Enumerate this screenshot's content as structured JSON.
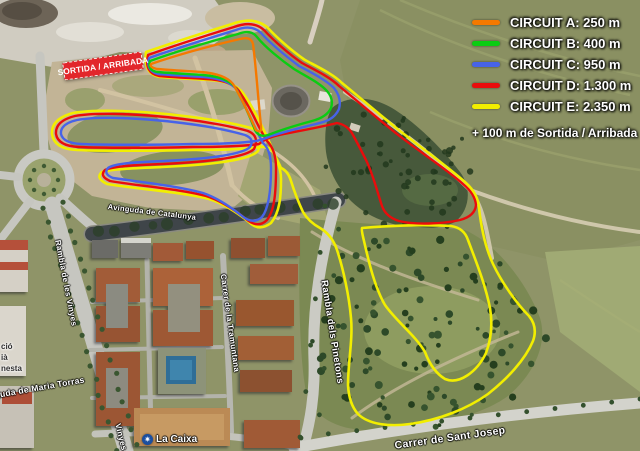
{
  "legend": {
    "items": [
      {
        "id": "A",
        "label": "CIRCUIT A: 250 m",
        "color": "#F57900"
      },
      {
        "id": "B",
        "label": "CIRCUIT B: 400 m",
        "color": "#0ACC12"
      },
      {
        "id": "C",
        "label": "CIRCUIT C: 950 m",
        "color": "#4763E8"
      },
      {
        "id": "D",
        "label": "CIRCUIT D: 1.300 m",
        "color": "#EA0C0C"
      },
      {
        "id": "E",
        "label": "CIRCUIT E: 2.350 m",
        "color": "#F2EE00"
      }
    ],
    "note": "+ 100 m de Sortida / Arribada"
  },
  "banner": {
    "text": "SORTIDA / ARRIBADA"
  },
  "streets": [
    {
      "text": "Rambla de les Vinyes",
      "x": 66,
      "y": 283,
      "rot": 79,
      "size": 8
    },
    {
      "text": "Vinyes",
      "x": 121,
      "y": 437,
      "rot": 76,
      "size": 8
    },
    {
      "text": "Avinguda de Catalunya",
      "x": 152,
      "y": 212,
      "rot": 7,
      "size": 7.5
    },
    {
      "text": "Carrer de la Tramuntana",
      "x": 230,
      "y": 323,
      "rot": 82,
      "size": 8
    },
    {
      "text": "Rambla dels Pinetons",
      "x": 332,
      "y": 332,
      "rot": 81,
      "size": 9.5
    },
    {
      "text": "Carrer de Sant Josep",
      "x": 450,
      "y": 438,
      "rot": -8,
      "size": 10.5
    },
    {
      "text": "Avinguda de Maria Torras",
      "x": 30,
      "y": 389,
      "rot": -10,
      "size": 8.5
    }
  ],
  "pois": {
    "bank": {
      "label": "La Caixa"
    },
    "edge_fragments": [
      {
        "text": "ció",
        "x": 1,
        "y": 342
      },
      {
        "text": "ià",
        "x": 1,
        "y": 353
      },
      {
        "text": "nesta",
        "x": 1,
        "y": 364
      }
    ]
  }
}
